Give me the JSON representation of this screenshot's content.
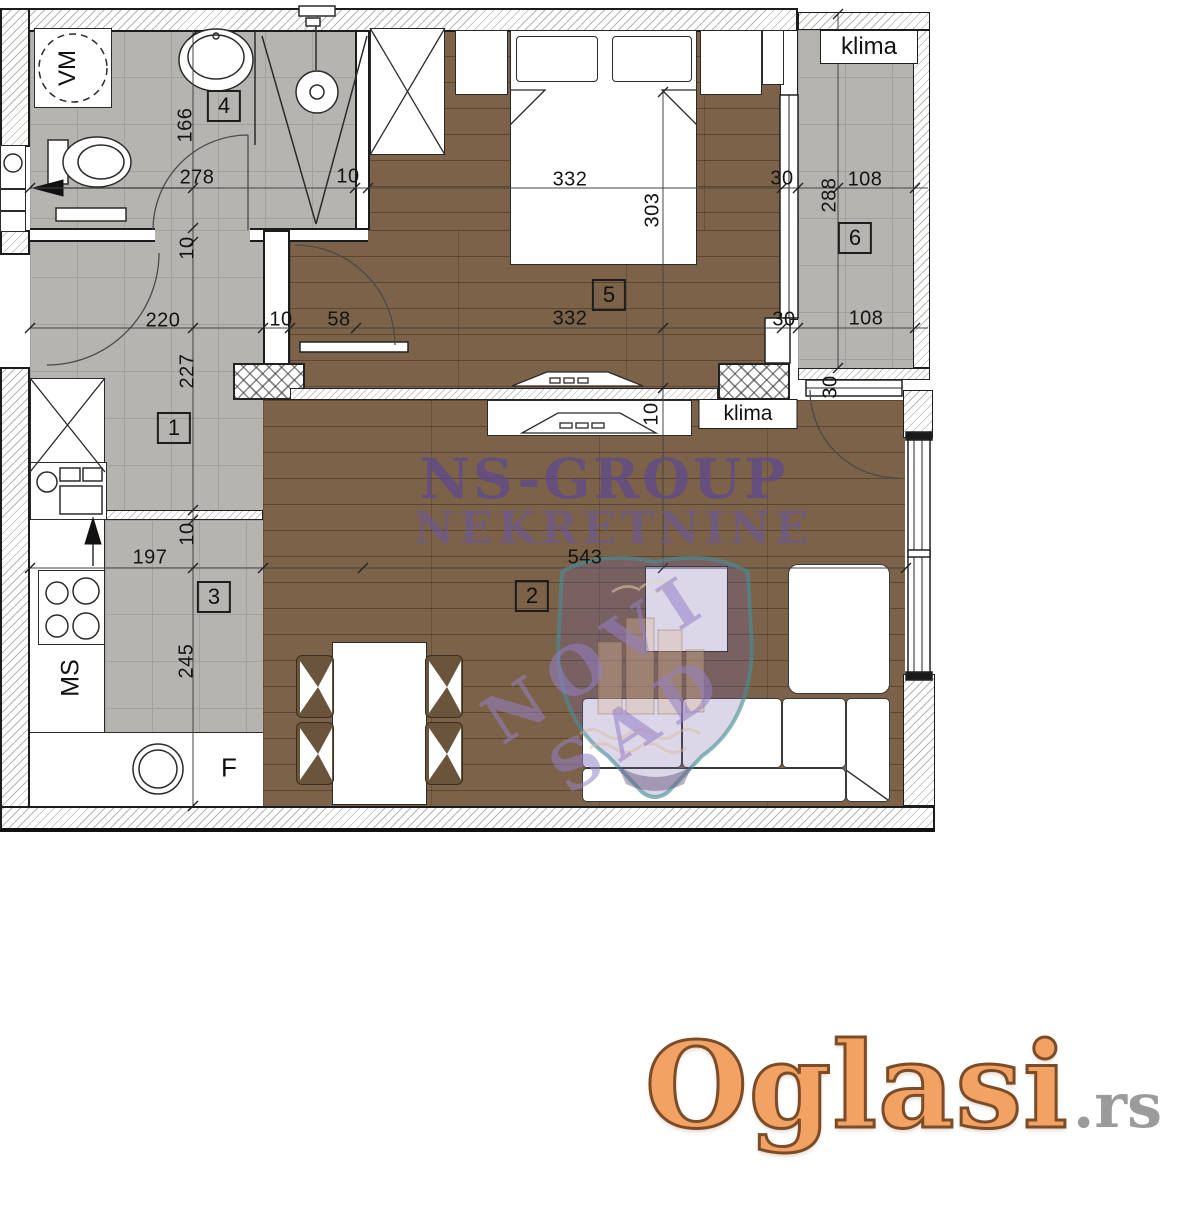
{
  "watermark": {
    "line1": "NS-GROUP",
    "line2": "NEKRETNINE",
    "line3": "NOVI SAD"
  },
  "logo": {
    "name": "Oglasi",
    "tld": ".rs"
  },
  "plan": {
    "room_numbers": [
      {
        "text": "1",
        "x": 174,
        "y": 428
      },
      {
        "text": "2",
        "x": 532,
        "y": 596
      },
      {
        "text": "3",
        "x": 214,
        "y": 597
      },
      {
        "text": "4",
        "x": 224,
        "y": 106
      },
      {
        "text": "5",
        "x": 609,
        "y": 295
      },
      {
        "text": "6",
        "x": 855,
        "y": 238
      }
    ],
    "dimensions": [
      {
        "text": "166",
        "x": 186,
        "y": 125,
        "rot": -90
      },
      {
        "text": "278",
        "x": 197,
        "y": 178,
        "rot": 0
      },
      {
        "text": "10",
        "x": 348,
        "y": 177,
        "rot": 0
      },
      {
        "text": "332",
        "x": 570,
        "y": 180,
        "rot": 0
      },
      {
        "text": "303",
        "x": 653,
        "y": 210,
        "rot": -90
      },
      {
        "text": "30",
        "x": 782,
        "y": 179,
        "rot": 0
      },
      {
        "text": "288",
        "x": 830,
        "y": 195,
        "rot": -90
      },
      {
        "text": "108",
        "x": 865,
        "y": 180,
        "rot": 0
      },
      {
        "text": "10",
        "x": 188,
        "y": 248,
        "rot": -90
      },
      {
        "text": "220",
        "x": 163,
        "y": 321,
        "rot": 0
      },
      {
        "text": "10",
        "x": 281,
        "y": 320,
        "rot": 0
      },
      {
        "text": "58",
        "x": 339,
        "y": 320,
        "rot": 0
      },
      {
        "text": "332",
        "x": 570,
        "y": 319,
        "rot": 0
      },
      {
        "text": "30",
        "x": 784,
        "y": 320,
        "rot": 0
      },
      {
        "text": "108",
        "x": 866,
        "y": 319,
        "rot": 0
      },
      {
        "text": "227",
        "x": 188,
        "y": 371,
        "rot": -90
      },
      {
        "text": "10",
        "x": 652,
        "y": 414,
        "rot": -90
      },
      {
        "text": "30",
        "x": 831,
        "y": 387,
        "rot": -90
      },
      {
        "text": "10",
        "x": 188,
        "y": 534,
        "rot": -90
      },
      {
        "text": "197",
        "x": 150,
        "y": 558,
        "rot": 0
      },
      {
        "text": "543",
        "x": 585,
        "y": 558,
        "rot": 0
      },
      {
        "text": "245",
        "x": 187,
        "y": 661,
        "rot": -90
      }
    ],
    "fixture_labels": [
      {
        "text": "klima",
        "x": 869,
        "y": 47,
        "box": true,
        "w": 96,
        "h": 32,
        "size": 24
      },
      {
        "text": "klima",
        "x": 748,
        "y": 414,
        "box": true,
        "w": 97,
        "h": 28,
        "size": 21
      },
      {
        "text": "VM",
        "x": 68,
        "y": 68,
        "rot": -90,
        "size": 24
      },
      {
        "text": "MS",
        "x": 71,
        "y": 678,
        "rot": -90,
        "size": 25
      },
      {
        "text": "F",
        "x": 229,
        "y": 768,
        "rot": 0,
        "size": 26
      }
    ]
  },
  "colors": {
    "tile": "#b6b4b0",
    "wood": "#7b6248",
    "watermark_purple": "#5d4894",
    "crest_teal": "#488c96",
    "logo_orange": "#f2a263",
    "logo_gray": "#9b9b9b"
  }
}
